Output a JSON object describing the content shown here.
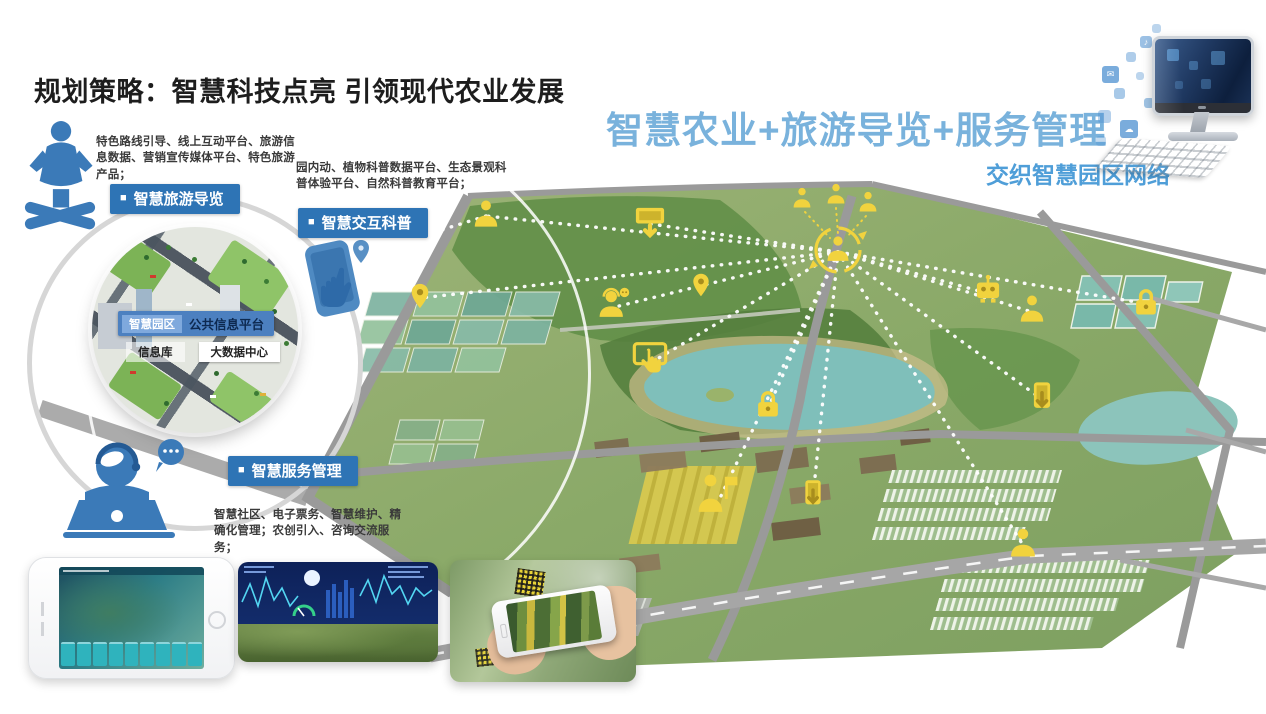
{
  "slide": {
    "title": "规划策略：智慧科技点亮 引领现代农业发展",
    "headline": "智慧农业+旅游导览+服务管理",
    "subheadline": "交织智慧园区网络",
    "bullet": "■"
  },
  "annotations": [
    {
      "badge": "智慧旅游导览",
      "desc": "特色路线引导、线上互动平台、旅游信息数据、营销宣传媒体平台、特色旅游产品；",
      "icon": "tour-guide-icon"
    },
    {
      "badge": "智慧交互科普",
      "desc": "园内动、植物科普数据平台、生态景观科普体验平台、自然科普教育平台；",
      "icon": "hand-touch-icon"
    },
    {
      "badge": "智慧服务管理",
      "desc": "智慧社区、电子票务、智慧维护、精确化管理；农创引入、咨询交流服务；",
      "icon": "service-desk-icon"
    }
  ],
  "inset": {
    "park_badge": "智慧园区",
    "platform_label": "公共信息平台",
    "info_db": "信息库",
    "big_data_center": "大数据中心"
  },
  "icons": {
    "computer-icon": "all-in-one PC with floating app squares",
    "hub-sync-icon": "central user inside circular arrows linked to three users",
    "person-icon": "standing visitor figure",
    "pin-icon": "map location pin",
    "lock-icon": "padlock (secure facility)",
    "monitor-arrow-icon": "screen with download arrow",
    "tablet-arrow-icon": "tablet with download arrow",
    "service-headset-icon": "service agent with headset and chat bubble",
    "hand-touch-icon": "hand tapping interactive screen",
    "guide-flag-icon": "tour guide holding flag",
    "robot-icon": "smart field robot device"
  },
  "mockups": {
    "phone_map": "park guide app on landscape phone",
    "dashboard": "data dashboard above terrain model",
    "ar_scan": "phone scanning plants with QR tags"
  },
  "colors": {
    "headline_blue": "#79B2DC",
    "subhead_blue": "#4F9ED8",
    "badge_blue": "#2E74B5",
    "icon_yellow": "#F1D33E",
    "lake_teal": "#7FBFBA",
    "title_black": "#1D1D1D"
  }
}
